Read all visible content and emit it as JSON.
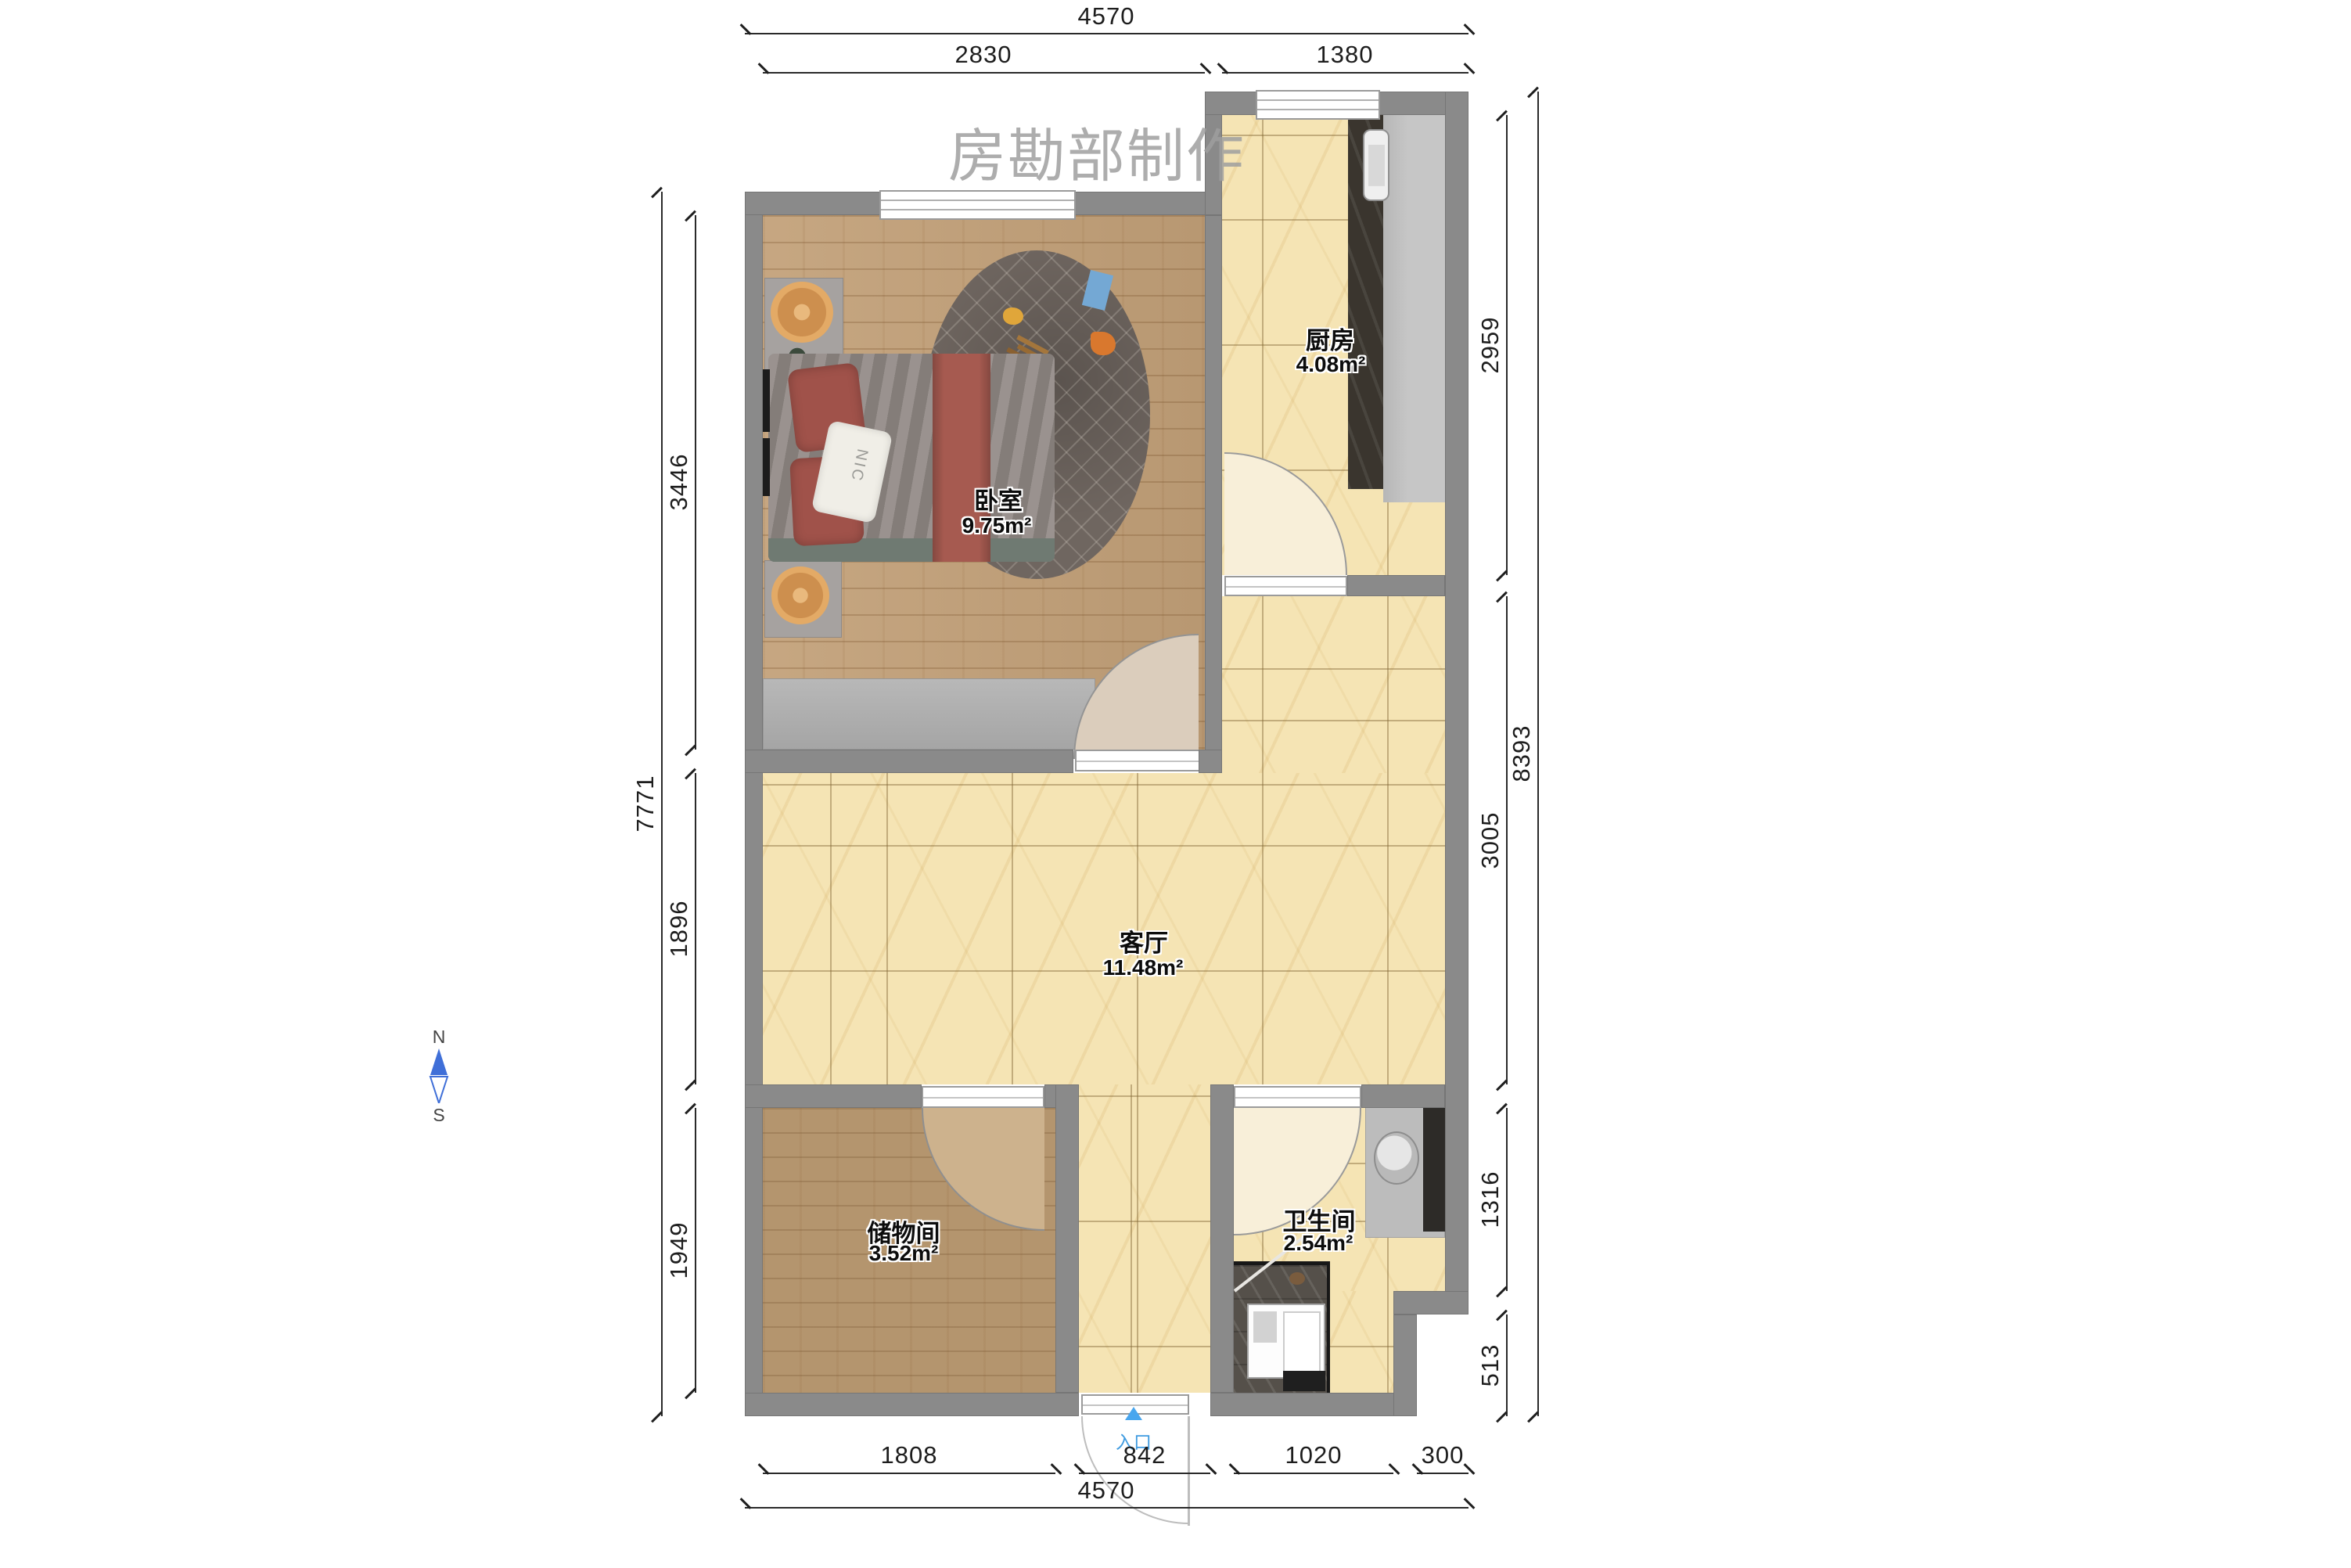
{
  "title": {
    "watermark": "房勘部制作"
  },
  "compass": {
    "north": "N",
    "south": "S"
  },
  "entrance": {
    "label": "入口"
  },
  "rooms": {
    "bedroom": {
      "name": "卧室",
      "area": "9.75m²"
    },
    "kitchen": {
      "name": "厨房",
      "area": "4.08m²"
    },
    "living": {
      "name": "客厅",
      "area": "11.48m²"
    },
    "storage": {
      "name": "储物间",
      "area": "3.52m²"
    },
    "bathroom": {
      "name": "卫生间",
      "area": "2.54m²"
    }
  },
  "dimensions": {
    "top": {
      "total": "4570",
      "bedroom": "2830",
      "kitchen": "1380"
    },
    "bottom": {
      "storage": "1808",
      "entry": "842",
      "bathroom": "1020",
      "step": "300",
      "total": "4570"
    },
    "left": {
      "bedroom": "3446",
      "living": "1896",
      "storage": "1949",
      "total": "7771"
    },
    "right": {
      "kitchen": "2959",
      "living": "3005",
      "bathroom": "1316",
      "step": "513",
      "total": "8393"
    }
  },
  "decor": {
    "pillow_text": "NIC"
  },
  "colors": {
    "wall": "#8a8a8a",
    "tile_floor": "#f5e4b4",
    "bedroom_wood": "#c2a078",
    "storage_wood": "#b4956e",
    "rug": "#6f6660",
    "bed_duvet": "#8e8682",
    "bed_stripe": "#a65a50",
    "counter_dark": "#3a352e",
    "entrance_blue": "#49a6ee",
    "compass_blue": "#3f6fd8",
    "watermark_gray": "#9f9f9f"
  }
}
